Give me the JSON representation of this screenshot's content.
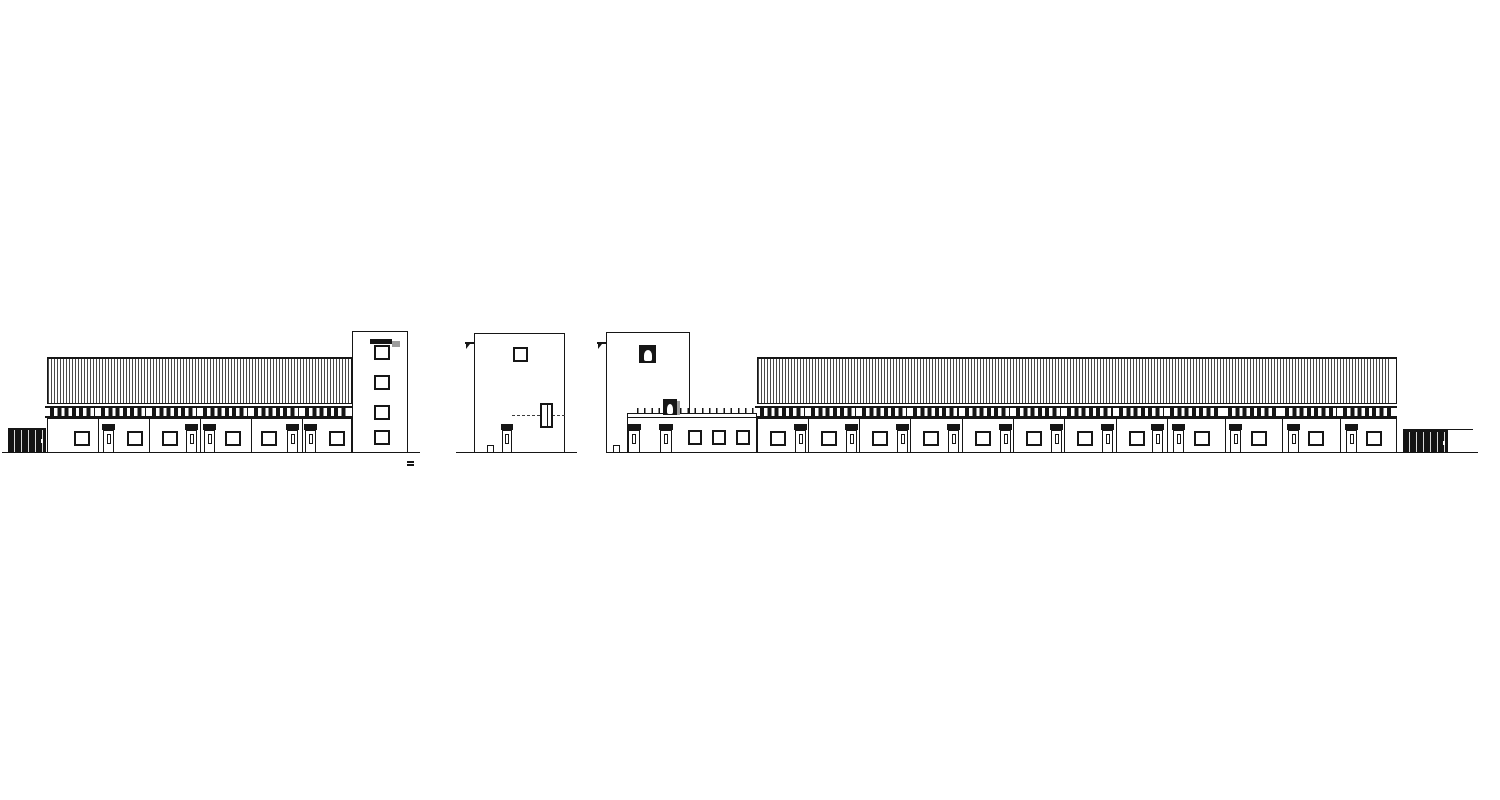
{
  "meta": {
    "drawing_type": "building-elevations",
    "canvas": {
      "w": 1500,
      "h": 800
    },
    "colors": {
      "paper": "#ffffff",
      "ink": "#161616",
      "shadow": "#9c9c9c",
      "gate_fill": "#141414"
    }
  },
  "dimensions": {
    "window": {
      "y": 431,
      "w": 16,
      "h": 15
    },
    "door": {
      "y": 430,
      "w": 11,
      "h": 23,
      "transom_h": 6,
      "pane_w": 4,
      "pane_h": 10
    }
  },
  "elevations": {
    "left": {
      "name": "left-elevation",
      "ground": {
        "x": 2,
        "y": 452,
        "w": 418
      },
      "gate": {
        "x": 8,
        "y": 428,
        "w": 38,
        "h": 24
      },
      "hall": {
        "x": 47,
        "w": 305,
        "roof_y": 357,
        "roof_h": 47,
        "band_y": 406,
        "band_h": 12,
        "wall_y": 418,
        "wall_h": 35,
        "joints": [
          98,
          149,
          200,
          251,
          302
        ],
        "louver_groups": [
          [
            50,
            45
          ],
          [
            101,
            45
          ],
          [
            152,
            45
          ],
          [
            203,
            45
          ],
          [
            254,
            45
          ],
          [
            305,
            44
          ]
        ],
        "windows": [
          74,
          127,
          162,
          225,
          261,
          329
        ],
        "doors": [
          103,
          186,
          204,
          287,
          305
        ]
      },
      "tower": {
        "x": 352,
        "y": 331,
        "w": 56,
        "h": 122,
        "win_x": 374,
        "win_w": 16,
        "win_h": 15,
        "win_ys": [
          345,
          375,
          405,
          430
        ],
        "awning": {
          "x": 370,
          "y": 339,
          "w": 22,
          "h": 5
        }
      },
      "datum_mark": {
        "x": 407,
        "y": 461,
        "bar_w": 7
      }
    },
    "gable": {
      "name": "gable-elevation",
      "ground": {
        "x": 456,
        "y": 452,
        "w": 121
      },
      "body": {
        "x": 474,
        "y": 333,
        "w": 91,
        "h": 120
      },
      "spout": {
        "x": 465,
        "y": 342
      },
      "window": {
        "x": 513,
        "y": 347,
        "w": 15,
        "h": 15
      },
      "dashed_line": {
        "x": 512,
        "y": 415,
        "w": 53
      },
      "recessed_window": {
        "x": 540,
        "y": 403,
        "w": 13,
        "h": 25
      },
      "door": {
        "x": 502,
        "w": 10
      },
      "bollard": {
        "x": 487,
        "y": 445,
        "w": 7,
        "h": 8
      }
    },
    "right": {
      "name": "right-elevation",
      "ground": {
        "x": 612,
        "y": 452,
        "w": 866
      },
      "spout": {
        "x": 597,
        "y": 342
      },
      "tower": {
        "x": 606,
        "y": 332,
        "w": 84,
        "h": 121,
        "bell_window": {
          "x": 639,
          "y": 345,
          "w": 17,
          "h": 18
        },
        "bell_door": {
          "x": 663,
          "y": 399,
          "w": 14,
          "h": 16
        }
      },
      "wing": {
        "x": 627,
        "y": 413,
        "w": 130,
        "h": 40,
        "coping_y": 417,
        "ticks": {
          "x": 637,
          "y": 408,
          "w": 120,
          "h": 5
        },
        "doors": [
          628,
          660
        ],
        "door_w": 12,
        "windows": [
          688,
          712,
          736
        ],
        "win_w": 14
      },
      "hall": {
        "x": 757,
        "w": 640,
        "roof_y": 357,
        "roof_h": 47,
        "band_y": 406,
        "band_h": 12,
        "wall_y": 418,
        "wall_h": 35,
        "joints": [
          808,
          859,
          910,
          962,
          1013,
          1064,
          1116,
          1167,
          1225,
          1282,
          1340
        ],
        "louver_groups": [
          [
            760,
            45
          ],
          [
            811,
            45
          ],
          [
            862,
            45
          ],
          [
            913,
            46
          ],
          [
            965,
            45
          ],
          [
            1016,
            45
          ],
          [
            1067,
            46
          ],
          [
            1119,
            45
          ],
          [
            1170,
            50
          ],
          [
            1228,
            50
          ],
          [
            1285,
            52
          ],
          [
            1343,
            51
          ]
        ],
        "windows": [
          770,
          821,
          872,
          923,
          975,
          1026,
          1077,
          1129,
          1194,
          1251,
          1308,
          1366
        ],
        "doors": [
          795,
          846,
          897,
          948,
          1000,
          1051,
          1102,
          1152,
          1173,
          1230,
          1288,
          1346
        ],
        "edge_strip": {
          "x": 1391,
          "y": 359,
          "w": 5,
          "h": 44
        }
      },
      "gate": {
        "x": 1403,
        "y": 430,
        "w": 45,
        "h": 22,
        "rail_y": 428.5,
        "rail_w": 70
      }
    }
  }
}
